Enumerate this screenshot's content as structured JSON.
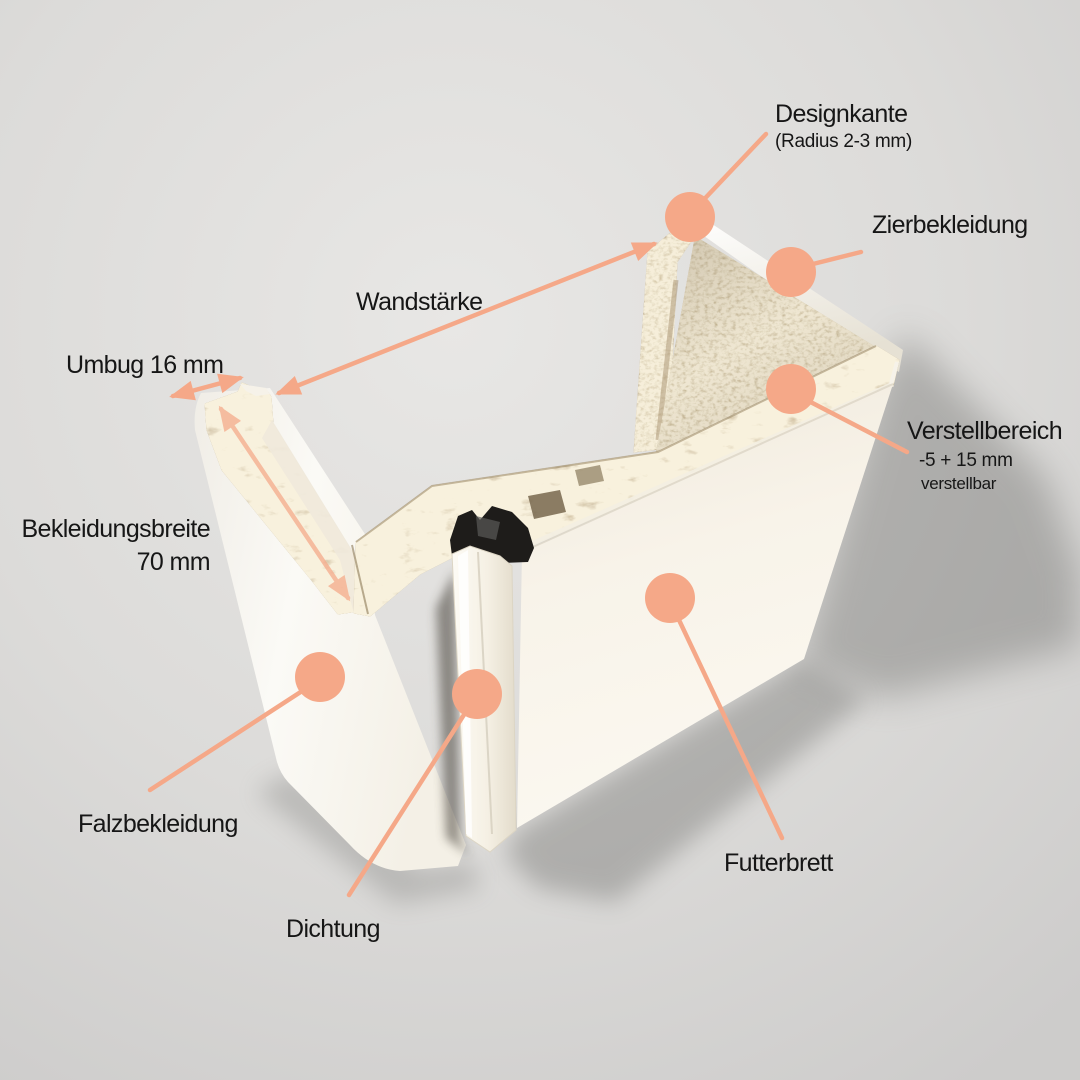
{
  "colors": {
    "accent": "#f5a888",
    "label_text": "#161616",
    "chipboard": "#bfa87e",
    "chipboard_light": "#d2c3a2",
    "panel_white": "#f7f3ea",
    "background": "#dbdad8",
    "shadow": "#6e6e6c",
    "seal_black": "#1e1c1a"
  },
  "annotations": {
    "designkante": {
      "label": "Designkante",
      "sublabel": "(Radius 2-3 mm)"
    },
    "zierbekleidung": {
      "label": "Zierbekleidung"
    },
    "wandstaerke": {
      "label": "Wandstärke"
    },
    "umbug": {
      "label": "Umbug 16 mm"
    },
    "verstellbereich": {
      "label": "Verstellbereich",
      "line2": "-5 + 15 mm",
      "line3": "verstellbar"
    },
    "bekleidungsbreite": {
      "line1": "Bekleidungsbreite",
      "line2": "70 mm"
    },
    "falzbekleidung": {
      "label": "Falzbekleidung"
    },
    "dichtung": {
      "label": "Dichtung"
    },
    "futterbrett": {
      "label": "Futterbrett"
    }
  }
}
